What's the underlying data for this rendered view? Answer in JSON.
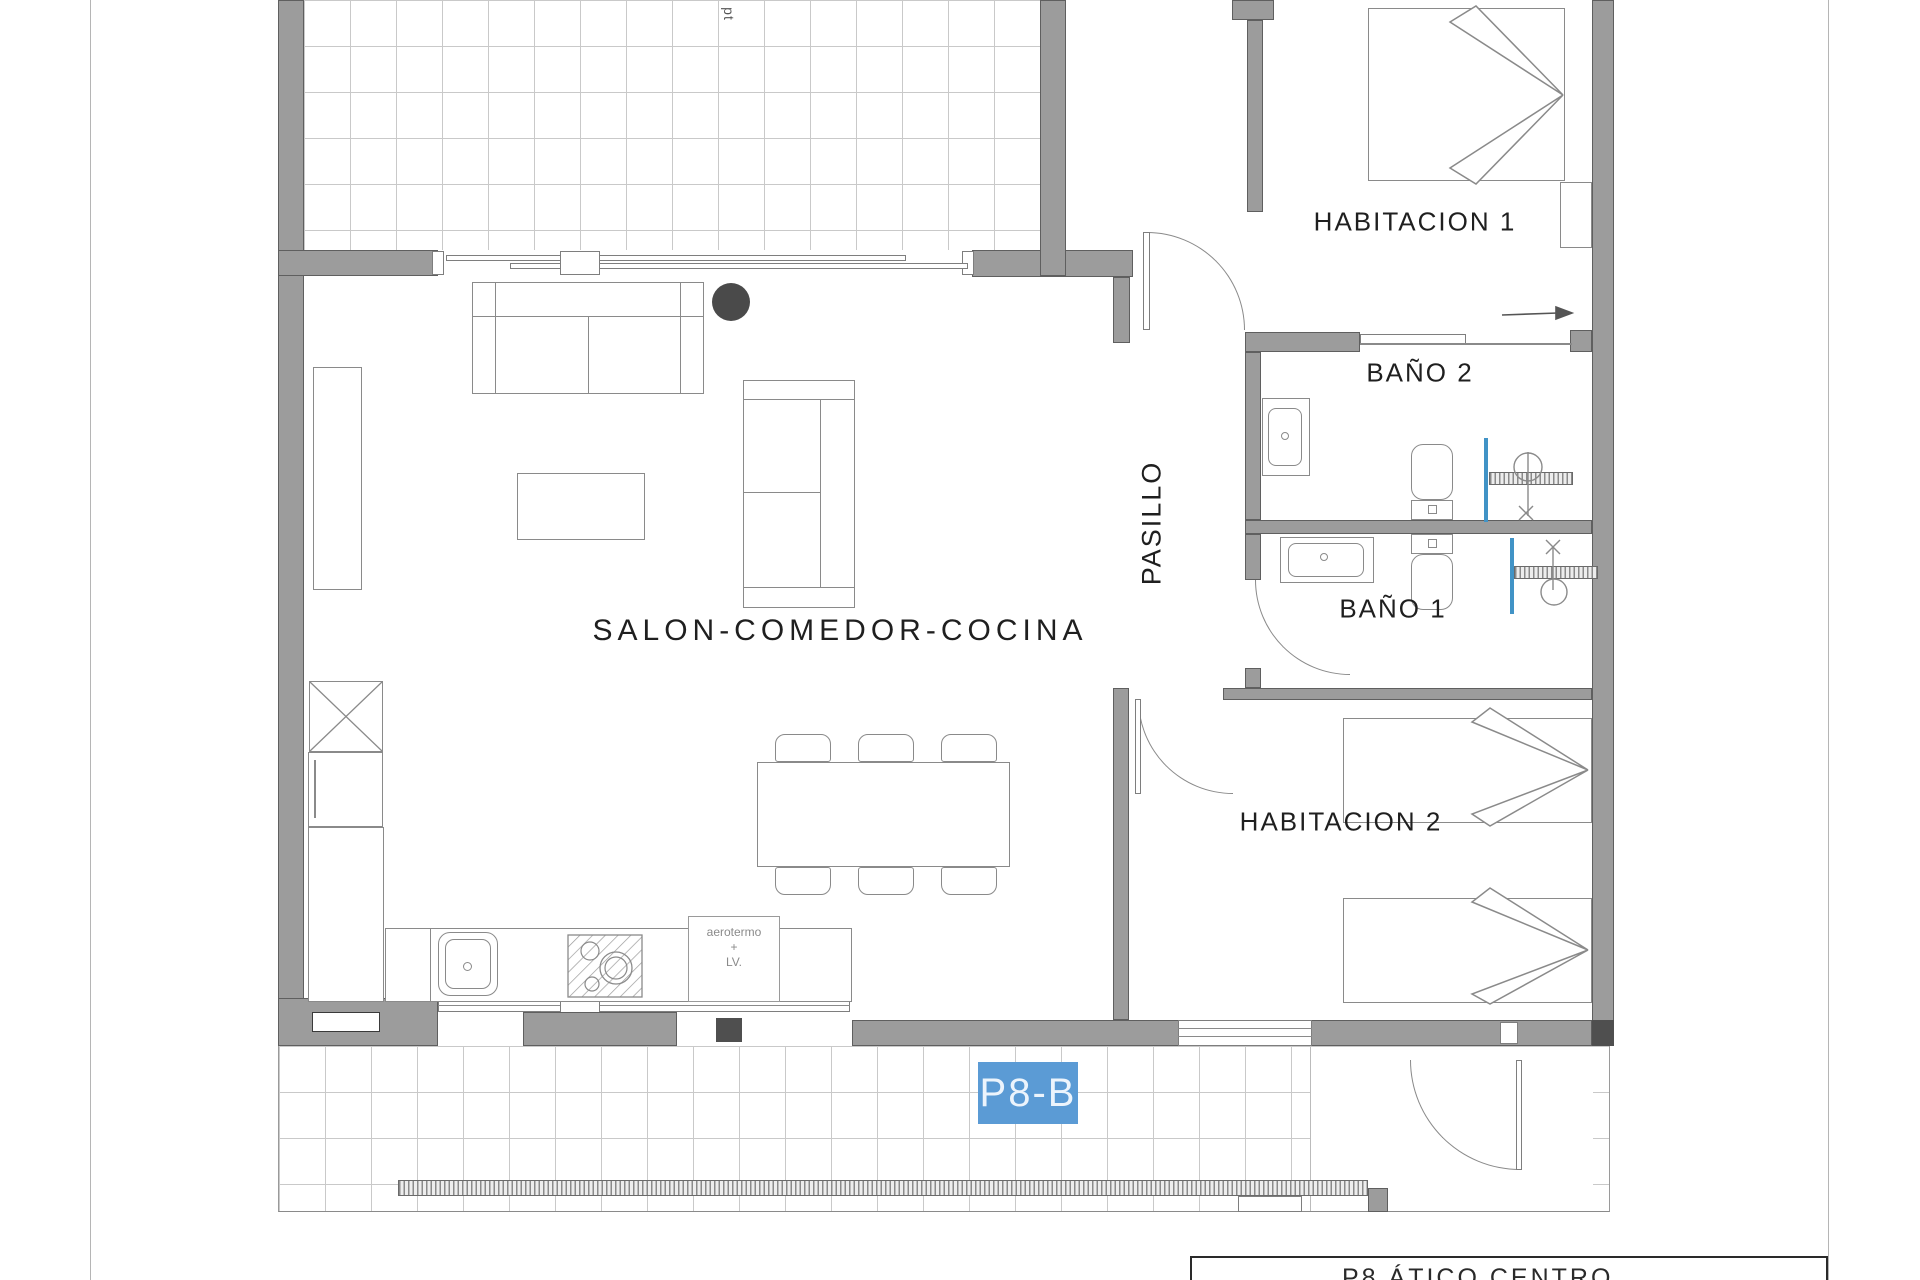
{
  "canvas": {
    "width": 1920,
    "height": 1280
  },
  "floorplan": {
    "rooms": {
      "living_room": {
        "label": "SALON-COMEDOR-COCINA"
      },
      "hallway": {
        "label": "PASILLO"
      },
      "bedroom_1": {
        "label": "HABITACION 1"
      },
      "bedroom_2": {
        "label": "HABITACION 2"
      },
      "bathroom_1": {
        "label": "BAÑO 1"
      },
      "bathroom_2": {
        "label": "BAÑO 2"
      }
    },
    "annotations": {
      "terrace_note": "pt",
      "utility_line1": "aerotermo",
      "utility_line2": "+",
      "utility_line3": "LV."
    },
    "unit_badge": {
      "label": "P8-B",
      "color": "#5b9bd5"
    },
    "title_block": {
      "text": "P8 ÁTICO  CENTRO"
    },
    "palette": {
      "wall_fill": "#9c9c9c",
      "wall_edge": "#5f5f5f",
      "line": "#8a8a8a",
      "tile_line": "#c9c9c9",
      "shower_glass": "#4193c6",
      "badge_blue": "#5b9bd5"
    }
  }
}
